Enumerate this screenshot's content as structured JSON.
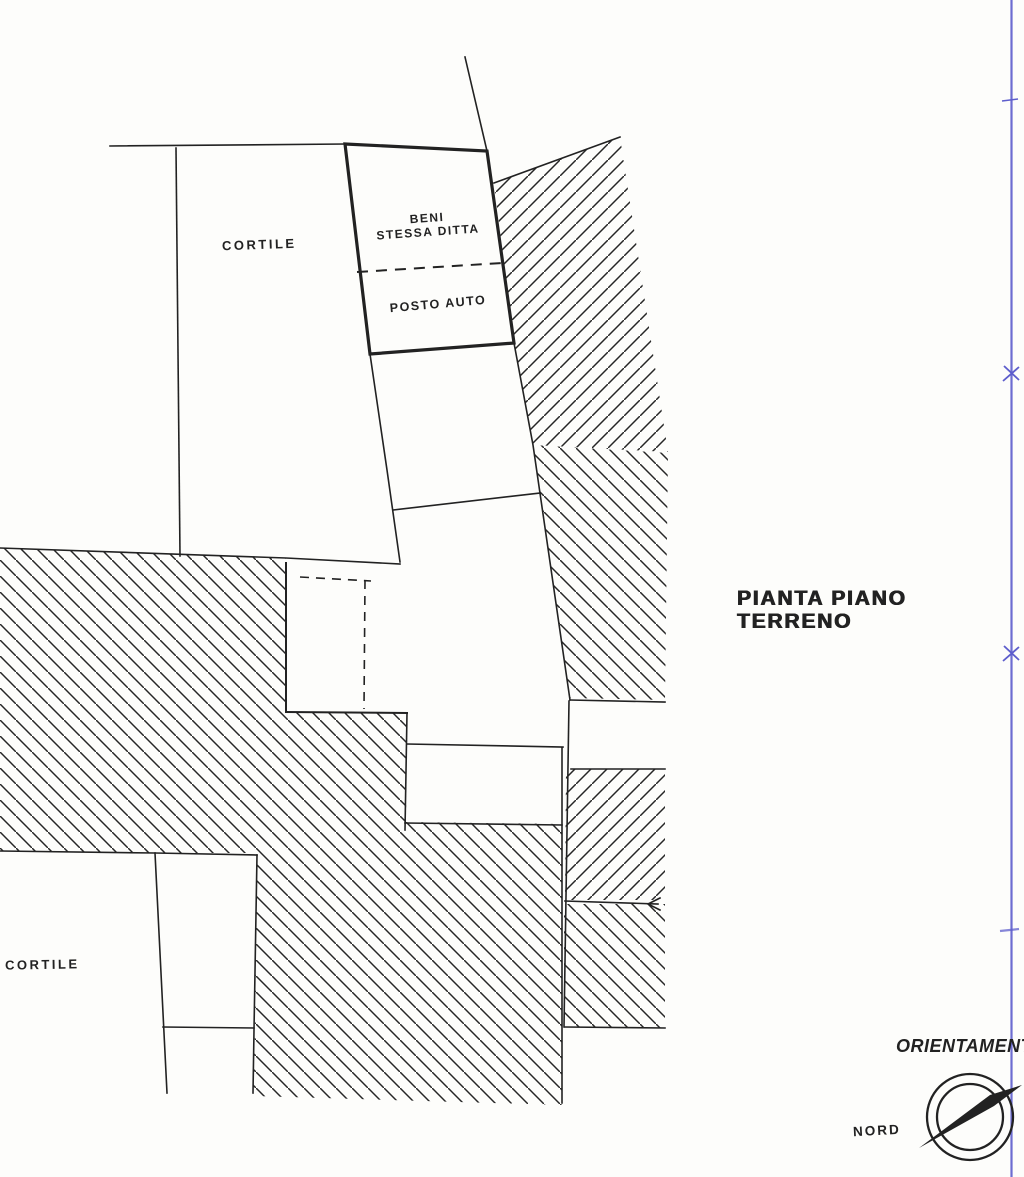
{
  "plan": {
    "areas": {
      "cortile_top": "CORTILE",
      "parcel_line1": "BENI",
      "parcel_line2": "STESSA DITTA",
      "parking": "POSTO AUTO",
      "cortile_bottom": "CORTILE"
    },
    "caption": {
      "line1": "PIANTA PIANO",
      "line2": "TERRENO"
    },
    "compass": {
      "label": "ORIENTAMENTO",
      "north": "NORD"
    },
    "colors": {
      "ink": "#222222",
      "fold_line": "#5d5dcc",
      "paper": "#fdfdfb"
    }
  }
}
